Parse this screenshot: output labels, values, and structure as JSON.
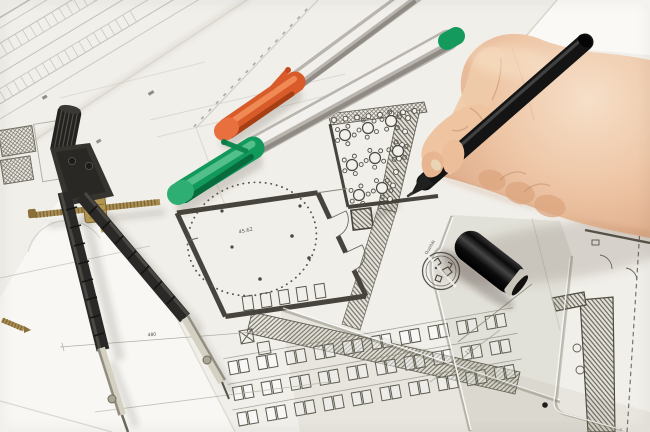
{
  "scene": {
    "type": "photograph",
    "subject": "Hand drawing with a black pen on architectural floor plans, with drafting compass, orange and green marker pens, a pen cap and a transparent set square lying on the drawings"
  },
  "labels": {
    "room_area": "45.62",
    "dim_small_1": "480",
    "dim_small_2": "170",
    "dim_small_3": "2514",
    "ruler_brand": "Qualität"
  },
  "colors": {
    "paper": "#f3f1ed",
    "plan_wall": "#46443c",
    "plan_faint": "#b8b4ac",
    "orange_cap": "#d95b2a",
    "green_cap": "#159a5d",
    "silver_body": "#d8d5d0",
    "black_pen": "#161616",
    "skin_light": "#f2d6bb",
    "skin_mid": "#eec6a6",
    "skin_shadow": "#c28b68",
    "brass": "#a98f52",
    "metal": "#cfcabb",
    "ruler_tint": "rgba(130,128,105,0.12)"
  },
  "plan_features": {
    "banquet_tables": 8,
    "chairs_per_table": 5,
    "desk_rows": 3,
    "desks_per_row": 10,
    "wall_column_circles_top": 8,
    "wall_column_circles_right": 7,
    "site_plan_rows": 7,
    "site_plan_stalls_per_band": 26,
    "title_text_dashes": 16
  }
}
